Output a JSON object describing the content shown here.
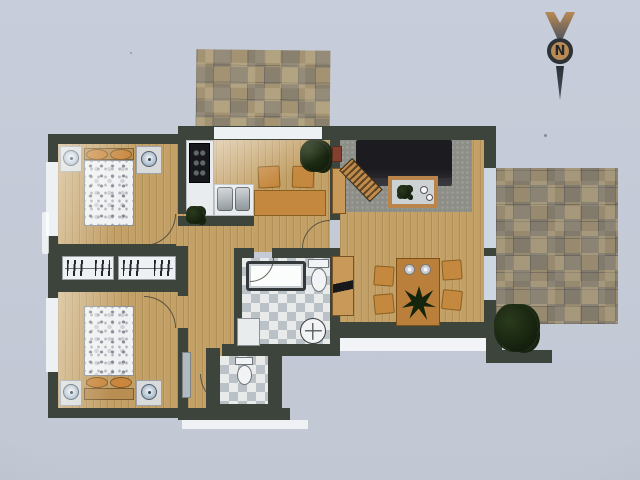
{
  "scene": {
    "description": "Photograph of a rendered apartment floor plan on light blue-grey paper, viewed top-down",
    "width_px": 640,
    "height_px": 480
  },
  "colors": {
    "bg-top": "#c7cdda",
    "bg-bottom": "#c1c7d3",
    "wall": "#3c443c",
    "wood": "#c3a066",
    "tile": "#a39373",
    "rug": "#8e8e88",
    "sofa": "#232327",
    "counter": "#e9ecee",
    "furniture": "#c5883f",
    "headboard": "#b98e52",
    "pillow": "#c8873d",
    "window": "#edf1f4",
    "window-blue": "#ccd7e3",
    "plant": "#1c2a14",
    "compass-dark": "#2d3237",
    "compass-tan": "#b98a54"
  },
  "compass": {
    "label": "N",
    "style": "chevron arrowhead above circled letter with tail spike, pointing up"
  },
  "plan": {
    "areas": [
      {
        "name": "terrace-top",
        "surface": "mottled stone tiles"
      },
      {
        "name": "bedroom-upper",
        "surface": "wood plank",
        "contents": [
          "double bed with floral white duvet",
          "two tan pillows",
          "wood headboard",
          "left nightstand with round lamp",
          "right nightstand with round lamp",
          "window on left wall",
          "door lower right"
        ]
      },
      {
        "name": "wardrobe-band",
        "contents": [
          "closet with hanging clothes",
          "closet with hanging clothes"
        ]
      },
      {
        "name": "bedroom-lower",
        "surface": "wood plank",
        "contents": [
          "double bed with floral white duvet",
          "two tan pillows",
          "wood headboard",
          "two nightstands with round lamps",
          "window on left wall",
          "door upper right"
        ]
      },
      {
        "name": "kitchen",
        "surface": "wood plank",
        "contents": [
          "black stove with burners",
          "white L counter",
          "double sink",
          "small table",
          "two chairs",
          "corner plant",
          "window to top terrace"
        ]
      },
      {
        "name": "hallway",
        "surface": "wood plank",
        "contents": [
          "small plant",
          "wall radiator",
          "entry door arc"
        ]
      },
      {
        "name": "bathroom",
        "surface": "checkered grey tiles",
        "contents": [
          "bathtub",
          "toilet",
          "round washbasin",
          "white cabinet"
        ]
      },
      {
        "name": "wc",
        "surface": "checkered grey tiles",
        "contents": [
          "toilet"
        ]
      },
      {
        "name": "living-room",
        "surface": "wood plank",
        "contents": [
          "dark grey sofa",
          "grey area rug",
          "coffee table with plant and cups",
          "slatted wooden lounger",
          "sideboard",
          "tv cabinet",
          "dining table",
          "four chairs",
          "two place settings",
          "centerpiece plant",
          "two windows on right wall"
        ]
      },
      {
        "name": "terrace-right",
        "surface": "mottled stone tiles",
        "contents": [
          "large plant at lower corner",
          "L-shaped parapet wall"
        ]
      }
    ]
  }
}
